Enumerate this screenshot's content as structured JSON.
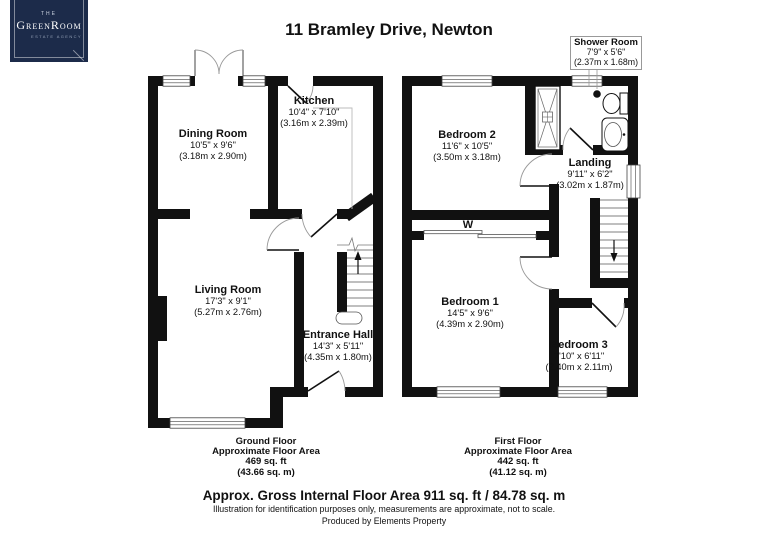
{
  "logo": {
    "the": "THE",
    "name": "GreenRoom",
    "tagline": "ESTATE AGENCY"
  },
  "title": "11 Bramley Drive, Newton",
  "colors": {
    "navy": "#1c2b4a",
    "wall": "#111111",
    "arc": "#999999"
  },
  "ground_floor": {
    "rooms": [
      {
        "name": "Dining Room",
        "imperial": "10'5\" x 9'6\"",
        "metric": "(3.18m x 2.90m)"
      },
      {
        "name": "Kitchen",
        "imperial": "10'4\" x 7'10\"",
        "metric": "(3.16m x 2.39m)"
      },
      {
        "name": "Living Room",
        "imperial": "17'3\" x 9'1\"",
        "metric": "(5.27m x 2.76m)"
      },
      {
        "name": "Entrance Hall",
        "imperial": "14'3\" x 5'11\"",
        "metric": "(4.35m x 1.80m)"
      }
    ],
    "caption": [
      "Ground Floor",
      "Approximate Floor Area",
      "469 sq. ft",
      "(43.66 sq. m)"
    ]
  },
  "first_floor": {
    "rooms": [
      {
        "name": "Bedroom 2",
        "imperial": "11'6\" x 10'5\"",
        "metric": "(3.50m x 3.18m)"
      },
      {
        "name": "Shower Room",
        "imperial": "7'9\" x 5'6\"",
        "metric": "(2.37m x 1.68m)"
      },
      {
        "name": "Landing",
        "imperial": "9'11\" x 6'2\"",
        "metric": "(3.02m x 1.87m)"
      },
      {
        "name": "Bedroom 1",
        "imperial": "14'5\" x 9'6\"",
        "metric": "(4.39m x 2.90m)"
      },
      {
        "name": "Bedroom 3",
        "imperial": "7'10\" x 6'11\"",
        "metric": "(2.40m x 2.11m)"
      },
      {
        "name": "W"
      }
    ],
    "caption": [
      "First Floor",
      "Approximate Floor Area",
      "442 sq. ft",
      "(41.12 sq. m)"
    ]
  },
  "footer": {
    "gross_area": "Approx. Gross Internal Floor Area 911 sq. ft / 84.78 sq. m",
    "disclaimer": "Illustration for identification purposes only, measurements are approximate, not to scale.",
    "produced_by": "Produced by Elements Property"
  }
}
